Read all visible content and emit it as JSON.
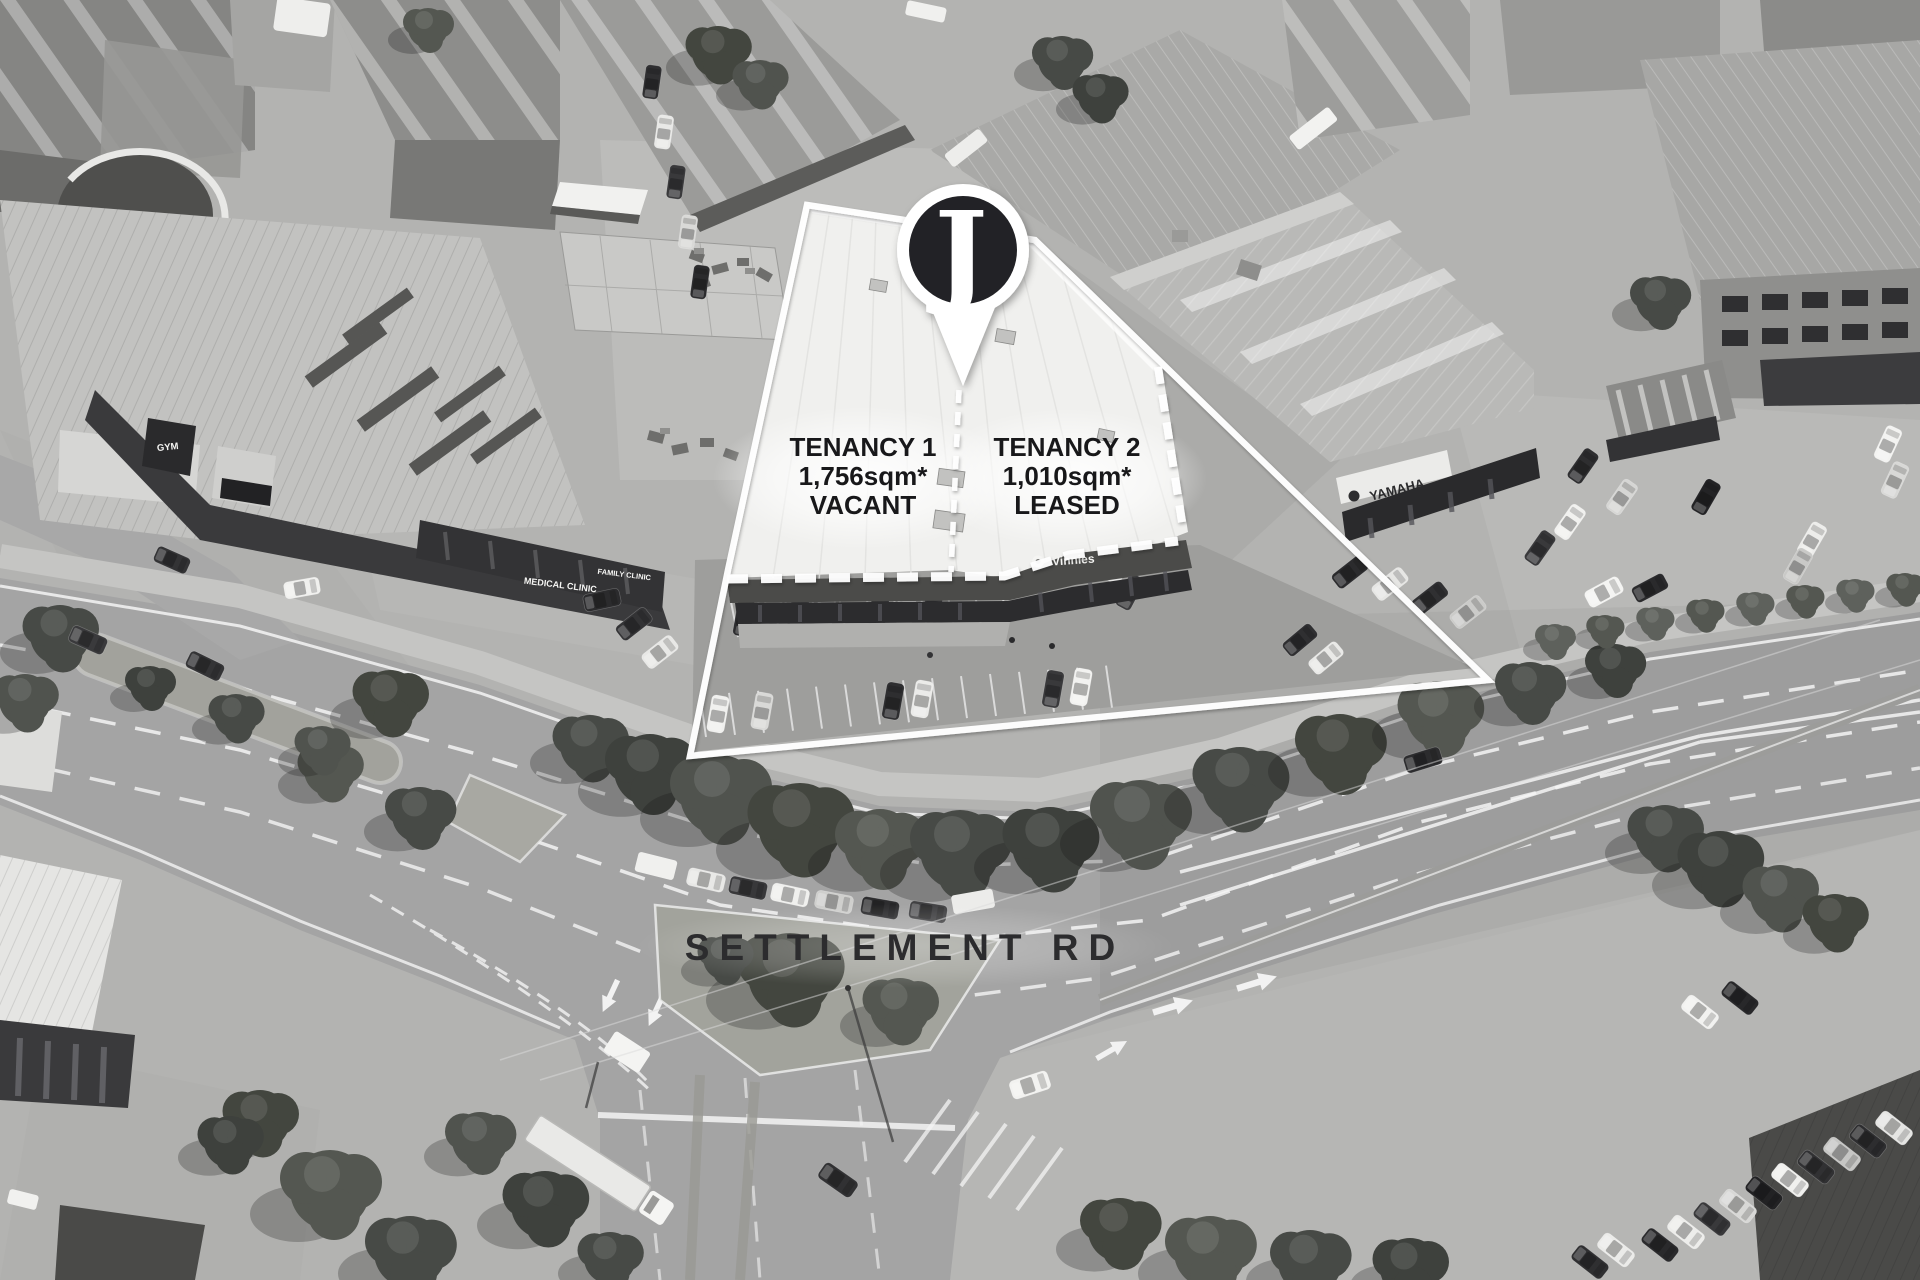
{
  "annotations": {
    "pin": {
      "label": "J"
    },
    "tenancy1": {
      "title": "TENANCY 1",
      "area": "1,756sqm*",
      "status": "VACANT"
    },
    "tenancy2": {
      "title": "TENANCY 2",
      "area": "1,010sqm*",
      "status": "LEASED"
    },
    "road_label": "SETTLEMENT RD"
  },
  "signage": {
    "vinnies": "Vinnies",
    "yamaha": "YAMAHA",
    "moto": "MOTO",
    "medical_clinic": "MEDICAL CLINIC",
    "family_clinic": "FAMILY CLINIC",
    "gym": "GYM"
  },
  "colors": {
    "boundary": "#ffffff",
    "pin_fill": "#232428",
    "annotation_text": "#18181a",
    "road_label_text": "#2c2c2e"
  }
}
